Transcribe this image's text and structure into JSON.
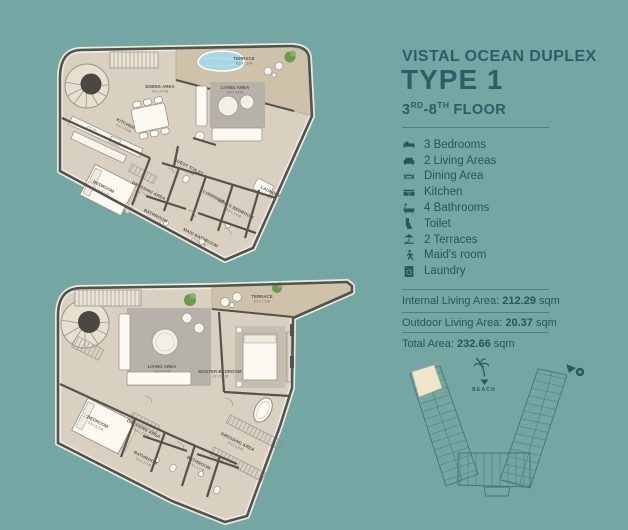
{
  "colors": {
    "background": "#74A6A4",
    "heading": "#2E5D68",
    "text": "#24565F",
    "rule": "#4D7F86",
    "plan_floor": "#D9D0C2",
    "plan_terrace": "#CFC2AB",
    "plan_wall": "#55514B",
    "rug": "#B7B2A9",
    "pool": "#A8D6E2",
    "plant": "#6D9854",
    "keyplan_line": "#42747A",
    "unit_highlight": "#EFE6CC"
  },
  "header": {
    "title": "VISTAL OCEAN DUPLEX",
    "type": "TYPE 1",
    "floor": {
      "n1": "3",
      "s1": "RD",
      "n2": "-8",
      "s2": "TH",
      "rest": "FLOOR"
    }
  },
  "features": [
    {
      "icon": "bed-icon",
      "label": "3 Bedrooms"
    },
    {
      "icon": "sofa-icon",
      "label": "2 Living Areas"
    },
    {
      "icon": "dining-table-icon",
      "label": "Dining Area"
    },
    {
      "icon": "kitchen-icon",
      "label": "Kitchen"
    },
    {
      "icon": "bathtub-icon",
      "label": "4 Bathrooms"
    },
    {
      "icon": "toilet-icon",
      "label": "Toilet"
    },
    {
      "icon": "parasol-icon",
      "label": "2 Terraces"
    },
    {
      "icon": "maid-icon",
      "label": "Maid's room"
    },
    {
      "icon": "washing-machine-icon",
      "label": "Laundry"
    }
  ],
  "areas": [
    {
      "label": "Internal Living Area:",
      "value": "212.29",
      "unit": "sqm"
    },
    {
      "label": "Outdoor Living Area:",
      "value": "20.37",
      "unit": "sqm"
    },
    {
      "label": "Total Area:",
      "value": "232.66",
      "unit": "sqm"
    }
  ],
  "keyplan": {
    "beach_label": "BEACH"
  },
  "floorplans": {
    "upper": {
      "rooms": [
        {
          "n": "DINING AREA",
          "d": "4.0 x 4.4 M"
        },
        {
          "n": "KITCHEN",
          "d": "2.4 x 4.9 M"
        },
        {
          "n": "LIVING AREA",
          "d": "5.0 x 4.8 M"
        },
        {
          "n": "TERRACE",
          "d": "8.3 x 1.6 M"
        },
        {
          "n": "BEDROOM",
          "d": "3.7 x 5.1 M"
        },
        {
          "n": "GUEST TOILET",
          "d": "1.2 x 1.9 M"
        },
        {
          "n": "DRESSING AREA",
          "d": "1.7 x 1.9 M"
        },
        {
          "n": "BATHROOM",
          "d": "2.4 x 1.7 M"
        },
        {
          "n": "CORRIDOR",
          "d": ""
        },
        {
          "n": "LAUNDRY",
          "d": "1.7 x 1.9 M"
        },
        {
          "n": "MAID'S BEDROOM",
          "d": "2.6 x 1.9 M"
        },
        {
          "n": "MAID BATHROOM",
          "d": "1.7 x 2.1 M"
        }
      ]
    },
    "lower": {
      "rooms": [
        {
          "n": "LIVING AREA",
          "d": "4.2 x 4.4 M"
        },
        {
          "n": "TERRACE",
          "d": "8.0 x 1.5 M"
        },
        {
          "n": "MASTER BEDROOM",
          "d": "4.2 x 5.2 M"
        },
        {
          "n": "BEDROOM",
          "d": "3.9 x 5.0 M"
        },
        {
          "n": "DRESSING AREA",
          "d": "1.6 x 2.9 M"
        },
        {
          "n": "BATHROOM",
          "d": "2.4 x 1.7 M"
        },
        {
          "n": "BATHROOM",
          "d": "2.3 x 1.7 M"
        },
        {
          "n": "DRESSING AREA",
          "d": "2.3 x 1.6 M"
        }
      ]
    }
  }
}
